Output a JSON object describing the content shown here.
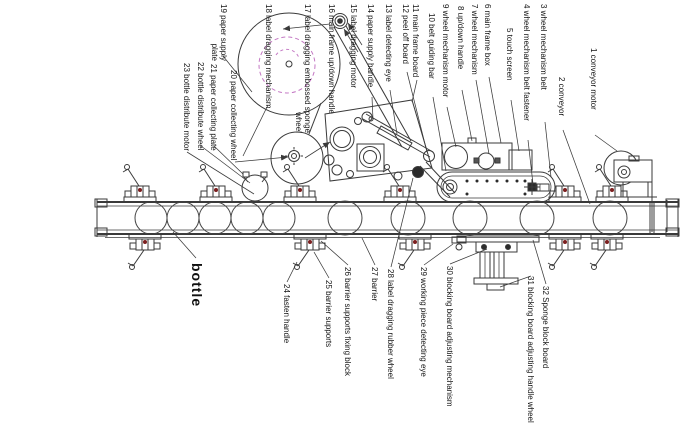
{
  "diagram": {
    "title": "bottle labeling machine parts diagram",
    "colors": {
      "line": "#3a3a3a",
      "magenta_dashed": "#c478c4",
      "pivot_dark_red": "#7c1f1f",
      "background": "#ffffff"
    },
    "big_label": {
      "text": "bottle",
      "x": 204,
      "y": 263,
      "leader": [
        196,
        258,
        173,
        232
      ],
      "arrow": false
    },
    "labels": [
      {
        "n": 1,
        "text": "1 conveyor motor",
        "x": 598,
        "y": 48,
        "leader": [
          595,
          135,
          617,
          151
        ],
        "arrow": false
      },
      {
        "n": 2,
        "text": "2 conveyor",
        "x": 566,
        "y": 77,
        "leader": [
          563,
          130,
          590,
          204
        ],
        "arrow": false
      },
      {
        "n": 3,
        "text": "3 wheel mechanism belt",
        "x": 548,
        "y": 4,
        "leader": [
          545,
          122,
          551,
          177
        ],
        "arrow": false
      },
      {
        "n": 4,
        "text": "4 wheel mechanism belt fastener",
        "x": 531,
        "y": 4,
        "leader": [
          528,
          140,
          533,
          184
        ],
        "arrow": false
      },
      {
        "n": 5,
        "text": "5 touch screen",
        "x": 514,
        "y": 28,
        "leader": [
          511,
          100,
          519,
          151
        ],
        "arrow": false
      },
      {
        "n": 6,
        "text": "6 main frame box",
        "x": 492,
        "y": 4,
        "leader": [
          489,
          77,
          501,
          143
        ],
        "arrow": false
      },
      {
        "n": 7,
        "text": "7 wheel mechanism",
        "x": 479,
        "y": 4,
        "leader": [
          476,
          80,
          489,
          154
        ],
        "arrow": false
      },
      {
        "n": 8,
        "text": "8 up/down handle",
        "x": 465,
        "y": 6,
        "leader": [
          462,
          90,
          472,
          141
        ],
        "arrow": false
      },
      {
        "n": 9,
        "text": "9 wheel mechanism motor",
        "x": 450,
        "y": 4,
        "leader": [
          447,
          107,
          456,
          147
        ],
        "arrow": false
      },
      {
        "n": 10,
        "text": "10 belt guiding bar",
        "x": 436,
        "y": 13,
        "leader": [
          433,
          97,
          446,
          171
        ],
        "arrow": false
      },
      {
        "n": 11,
        "text": "11 main frame board",
        "x": 420,
        "y": 4,
        "leader": [
          417,
          80,
          412,
          102
        ],
        "arrow": false
      },
      {
        "n": 12,
        "text": "12 peel off board",
        "x": 410,
        "y": 4,
        "leader": [
          407,
          72,
          427,
          152
        ],
        "arrow": false
      },
      {
        "n": 13,
        "text": "13 label detecting eye",
        "x": 393,
        "y": 4,
        "leader": [
          390,
          90,
          397,
          134
        ],
        "arrow": false
      },
      {
        "n": 14,
        "text": "14 paper supply handle",
        "x": 375,
        "y": 4,
        "leader": [
          372,
          97,
          373,
          120
        ],
        "arrow": false
      },
      {
        "n": 15,
        "text": "15 label dragging motor",
        "x": 358,
        "y": 4,
        "leader": [
          362,
          45,
          348,
          23
        ],
        "arrow": true
      },
      {
        "n": 16,
        "text": "16 main frame up/down handle",
        "x": 336,
        "y": 4,
        "leader": [
          330,
          24,
          283,
          29
        ],
        "arrow": true
      },
      {
        "n": 17,
        "text": "17 label dragging embossed sponge",
        "text2": "wheel",
        "x": 312,
        "y": 4,
        "leader": [
          305,
          158,
          330,
          142
        ],
        "arrow": true
      },
      {
        "n": 18,
        "text": "18 label dragging mechanism",
        "x": 273,
        "y": 4,
        "leader": [
          268,
          105,
          243,
          156
        ],
        "arrow": false
      },
      {
        "n": 19,
        "text": "19 paper supply",
        "text2": "plate",
        "x": 228,
        "y": 4,
        "leader": [
          223,
          56,
          252,
          92
        ],
        "arrow": false
      },
      {
        "n": 20,
        "text": "20 paper collecting wheel",
        "x": 238,
        "y": 70,
        "leader": [
          235,
          162,
          288,
          157
        ],
        "arrow": true
      },
      {
        "n": 21,
        "text": "21 paper collecting plate",
        "x": 218,
        "y": 64,
        "leader": [
          214,
          146,
          243,
          174
        ],
        "arrow": false
      },
      {
        "n": 22,
        "text": "22 bottle distribute wheel",
        "x": 205,
        "y": 62,
        "leader": [
          201,
          146,
          250,
          183
        ],
        "arrow": false
      },
      {
        "n": 23,
        "text": "23 bottle distribute motor",
        "x": 191,
        "y": 63,
        "leader": [
          187,
          152,
          254,
          194
        ],
        "arrow": false
      },
      {
        "n": 24,
        "text": "24 fasten handle",
        "x": 291,
        "y": 284,
        "leader": [
          287,
          282,
          297,
          262
        ],
        "arrow": false
      },
      {
        "n": 25,
        "text": "25 barrier supports",
        "x": 333,
        "y": 280,
        "leader": [
          329,
          278,
          314,
          252
        ],
        "arrow": false
      },
      {
        "n": 26,
        "text": "26 barrier supports fixing block",
        "x": 352,
        "y": 267,
        "leader": [
          348,
          265,
          321,
          241
        ],
        "arrow": false
      },
      {
        "n": 27,
        "text": "27 barrier",
        "x": 379,
        "y": 267,
        "leader": [
          375,
          265,
          362,
          238
        ],
        "arrow": false
      },
      {
        "n": 28,
        "text": "28 label dragging rubber wheel",
        "x": 395,
        "y": 269,
        "leader": [
          391,
          267,
          413,
          178
        ],
        "arrow": false
      },
      {
        "n": 29,
        "text": "29 working piece detecting eye",
        "x": 428,
        "y": 267,
        "leader": [
          424,
          265,
          453,
          244
        ],
        "arrow": false
      },
      {
        "n": 30,
        "text": "30 blocking board adjusting mechanism",
        "x": 454,
        "y": 266,
        "leader": [
          450,
          264,
          487,
          249
        ],
        "arrow": false
      },
      {
        "n": 31,
        "text": "31 blocking board adjusting handle wheel",
        "x": 535,
        "y": 276,
        "leader": [
          531,
          276,
          500,
          287
        ],
        "arrow": false
      },
      {
        "n": 32,
        "text": "32 Sponge block board",
        "x": 550,
        "y": 286,
        "leader": [
          546,
          284,
          533,
          240
        ],
        "arrow": false
      }
    ]
  }
}
